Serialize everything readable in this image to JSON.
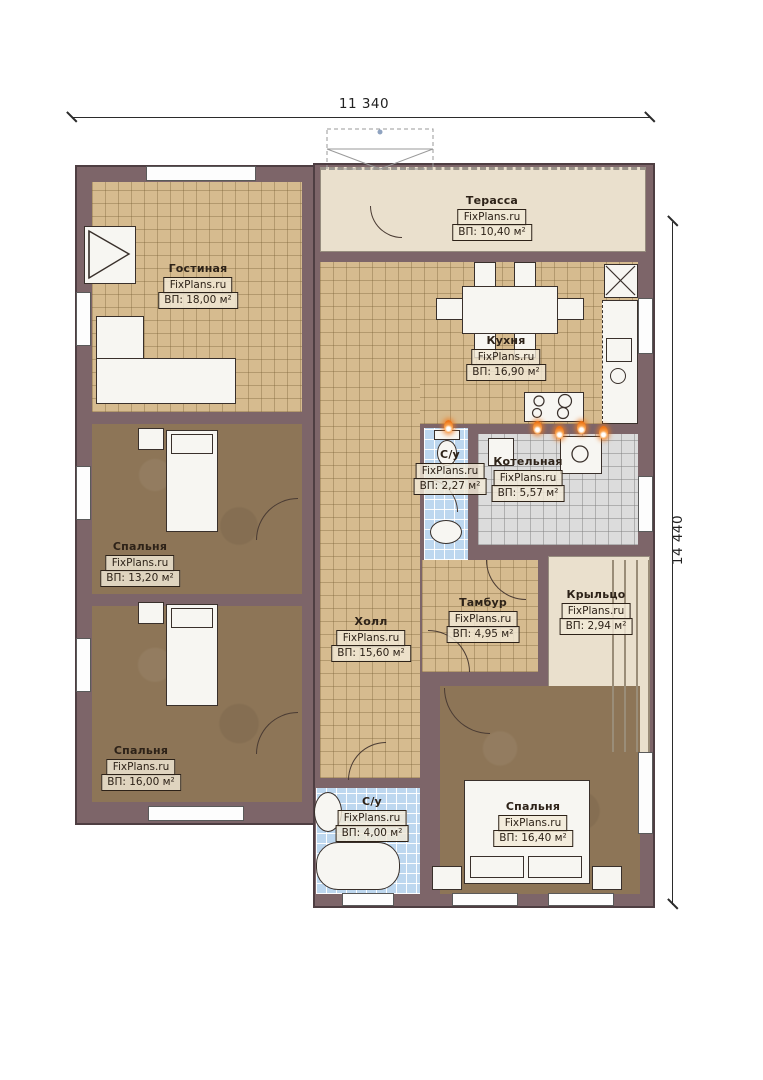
{
  "branding": {
    "site": "FixPlans.ru"
  },
  "dimensions": {
    "top": "11 340",
    "right": "14 440"
  },
  "rooms": [
    {
      "name": "Терасса",
      "area": "ВП: 10,40 м²"
    },
    {
      "name": "Гостиная",
      "area": "ВП: 18,00 м²"
    },
    {
      "name": "Кухня",
      "area": "ВП: 16,90 м²"
    },
    {
      "name": "С/у",
      "area": "ВП: 2,27 м²"
    },
    {
      "name": "Котельная",
      "area": "ВП: 5,57 м²"
    },
    {
      "name": "Спальня",
      "area": "ВП: 13,20 м²"
    },
    {
      "name": "Тамбур",
      "area": "ВП: 4,95 м²"
    },
    {
      "name": "Крыльцо",
      "area": "ВП: 2,94 м²"
    },
    {
      "name": "Холл",
      "area": "ВП: 15,60 м²"
    },
    {
      "name": "Спальня",
      "area": "ВП: 16,00 м²"
    },
    {
      "name": "С/у",
      "area": "ВП: 4,00 м²"
    },
    {
      "name": "Спальня",
      "area": "ВП: 16,40 м²"
    }
  ],
  "icons": {
    "fireplace": "fireplace-icon",
    "sofa": "sofa-icon",
    "dining_table": "dining-table-icon",
    "fridge": "fridge-icon",
    "cooktop": "cooktop-icon",
    "boiler": "boiler-icon",
    "toilet": "toilet-icon",
    "sink": "sink-icon",
    "bathtub": "bathtub-icon",
    "bed": "bed-icon",
    "flame": "flame-marker-icon"
  },
  "colors": {
    "wall": "#7d6569",
    "tile_beige": "#d6bb8f",
    "carpet_brown": "#8d7557",
    "tile_blue": "#bdd7ef",
    "tile_grey": "#dcdcdc",
    "cream": "#eae0cd",
    "flame_accent": "#ee7518"
  }
}
